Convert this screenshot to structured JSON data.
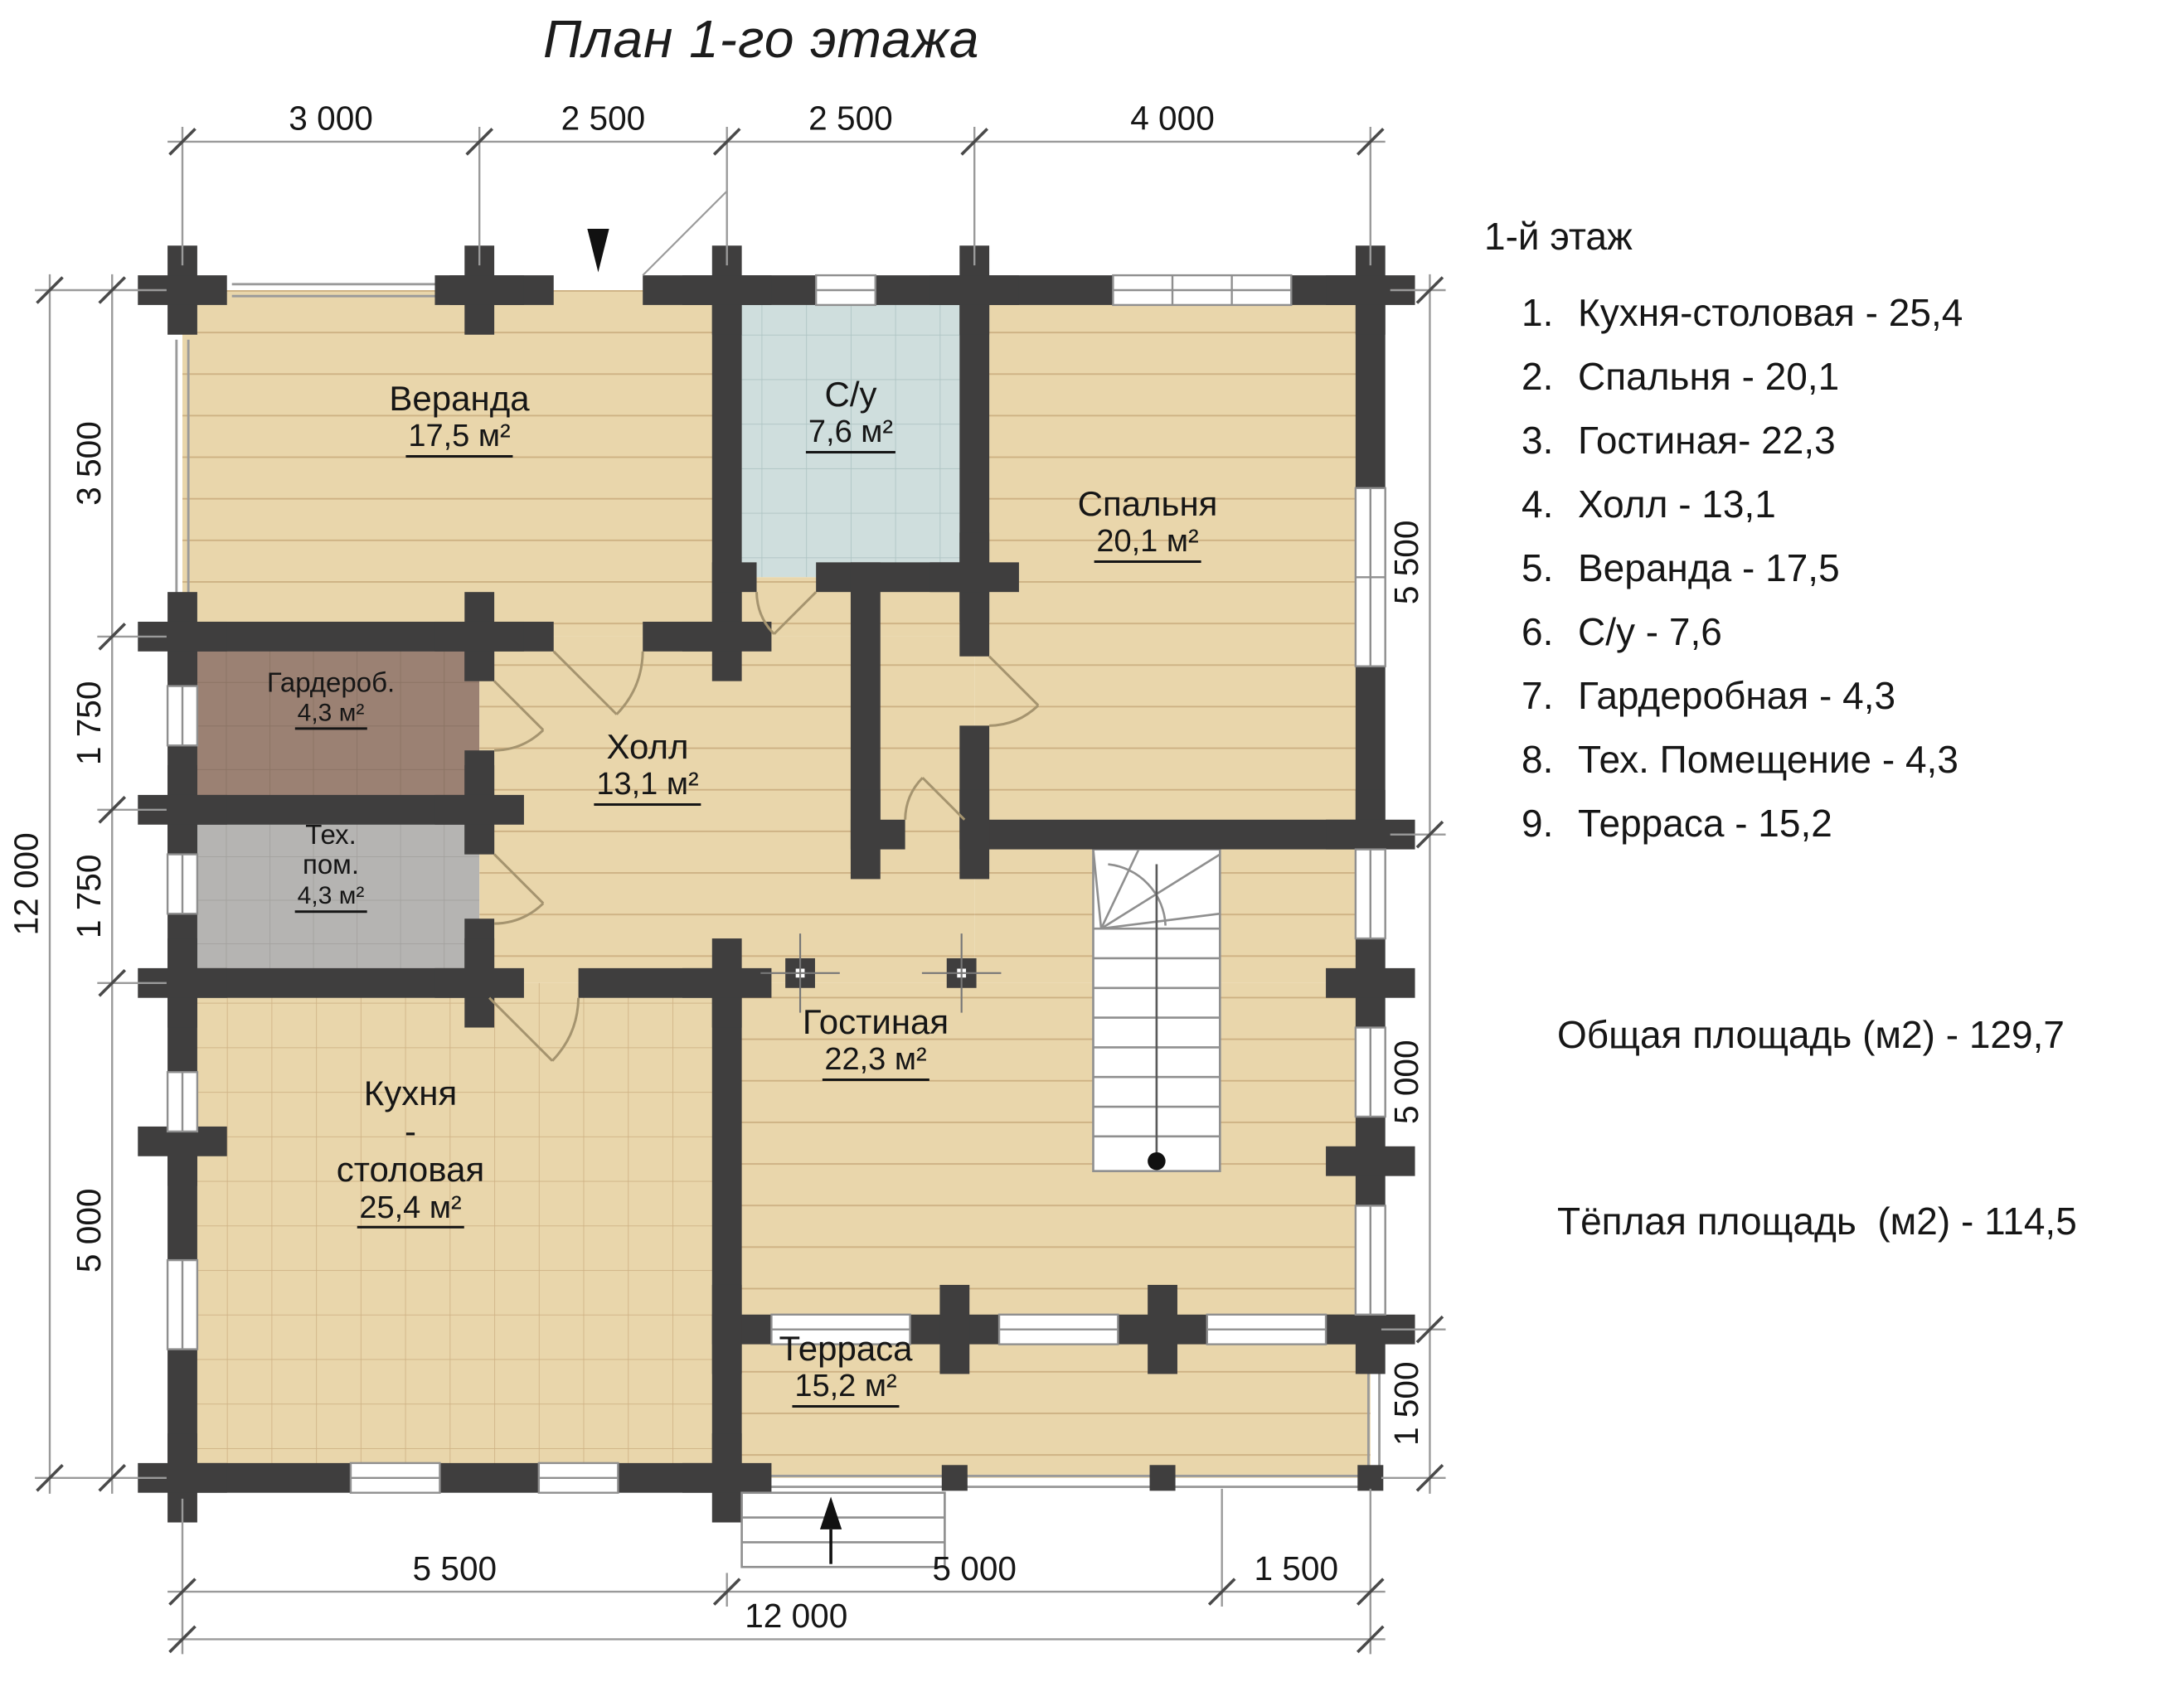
{
  "title": "План 1-го этажа",
  "legend": {
    "heading": "1-й этаж",
    "items": [
      {
        "num": "1.",
        "label": "Кухня-столовая - 25,4"
      },
      {
        "num": "2.",
        "label": "Спальня - 20,1"
      },
      {
        "num": "3.",
        "label": "Гостиная- 22,3"
      },
      {
        "num": "4.",
        "label": "Холл - 13,1"
      },
      {
        "num": "5.",
        "label": "Веранда - 17,5"
      },
      {
        "num": "6.",
        "label": "С/у - 7,6"
      },
      {
        "num": "7.",
        "label": "Гардеробная - 4,3"
      },
      {
        "num": "8.",
        "label": "Тех. Помещение - 4,3"
      },
      {
        "num": "9.",
        "label": "Терраса - 15,2"
      }
    ],
    "totals": [
      {
        "label": "Общая площадь (м2) - 129,7"
      },
      {
        "label": "Тёплая площадь  (м2) - 114,5"
      }
    ]
  },
  "rooms": {
    "veranda": {
      "name": "Веранда",
      "area": "17,5 м²"
    },
    "su": {
      "name": "С/у",
      "area": "7,6 м²"
    },
    "spalnya": {
      "name": "Спальня",
      "area": "20,1 м²"
    },
    "garderob": {
      "name": "Гардероб.",
      "area": "4,3 м²"
    },
    "tehpom": {
      "name": "Тех.\nпом.",
      "area": "4,3 м²"
    },
    "hall": {
      "name": "Холл",
      "area": "13,1 м²"
    },
    "gostinaya": {
      "name": "Гостиная",
      "area": "22,3 м²"
    },
    "kitchen": {
      "name": "Кухня\n-\nстоловая",
      "area": "25,4 м²"
    },
    "terrace": {
      "name": "Терраса",
      "area": "15,2 м²"
    }
  },
  "dims": {
    "top": [
      "3 000",
      "2 500",
      "2 500",
      "4 000"
    ],
    "left": [
      "3 500",
      "1 750",
      "1 750",
      "5 000"
    ],
    "left_total": "12 000",
    "right": [
      "5 500",
      "5 000",
      "1 500"
    ],
    "bottom": [
      "5 500",
      "5 000",
      "1 500"
    ],
    "bottom_total": "12 000"
  },
  "colors": {
    "wall": "#3f3e3e",
    "floor_wood": "#e9d6ab",
    "floor_bathroom": "#cfdedd",
    "floor_wardrobe": "#9b8173",
    "floor_tech": "#b5b4b2",
    "dim_lines": "#9a9a9a",
    "text": "#161616"
  }
}
